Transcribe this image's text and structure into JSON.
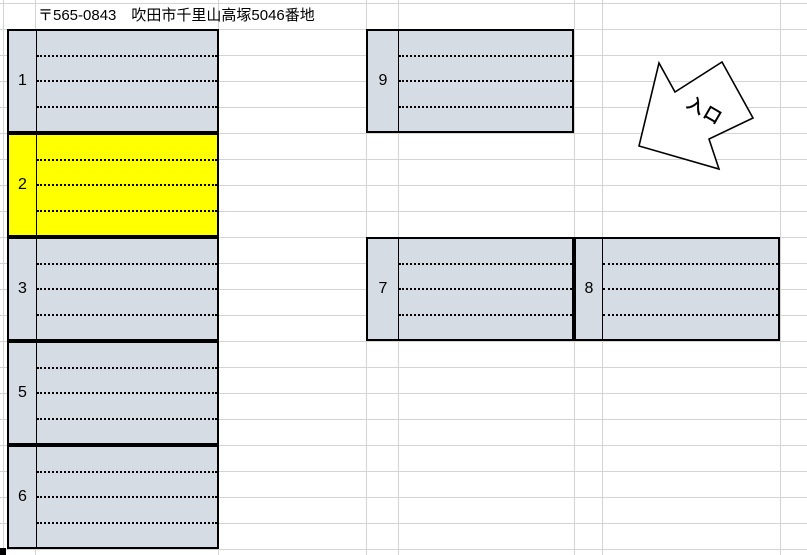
{
  "header": {
    "address": "〒565-0843　吹田市千里山高塚5046番地"
  },
  "entrance": {
    "label": "入口"
  },
  "spaces": [
    {
      "number": "1",
      "highlighted": false
    },
    {
      "number": "2",
      "highlighted": true
    },
    {
      "number": "3",
      "highlighted": false
    },
    {
      "number": "5",
      "highlighted": false
    },
    {
      "number": "6",
      "highlighted": false
    },
    {
      "number": "7",
      "highlighted": false
    },
    {
      "number": "8",
      "highlighted": false
    },
    {
      "number": "9",
      "highlighted": false
    }
  ],
  "colors": {
    "highlight": "#ffff00",
    "cell_fill": "#d6dce4",
    "gridline": "#d4d4d4",
    "border": "#000000",
    "arrow_fill": "#ffffff"
  }
}
